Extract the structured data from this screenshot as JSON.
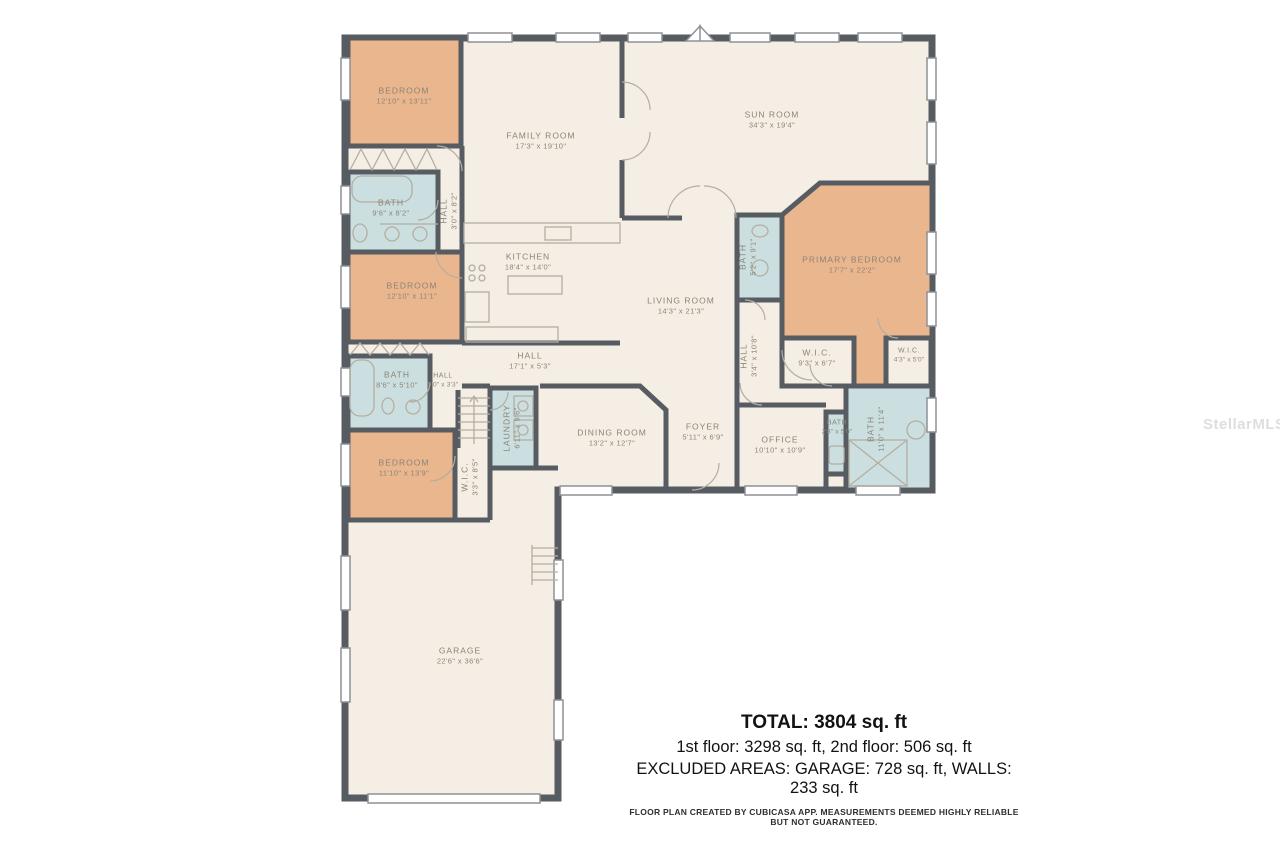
{
  "watermark": "StellarMLS",
  "colors": {
    "wall": "#575c63",
    "floor": "#f5eee4",
    "bedroom_fill": "#eab68e",
    "bath_fill": "#cbdfe0",
    "label_text": "#8b8476",
    "summary_text": "#121212"
  },
  "rooms": [
    {
      "id": "bedroom-1",
      "name": "BEDROOM",
      "dims": "12'10\" x 13'11\""
    },
    {
      "id": "family-room",
      "name": "FAMILY ROOM",
      "dims": "17'3\" x 19'10\""
    },
    {
      "id": "sun-room",
      "name": "SUN ROOM",
      "dims": "34'3\" x 19'4\""
    },
    {
      "id": "bath-1",
      "name": "BATH",
      "dims": "9'6\" x 8'2\""
    },
    {
      "id": "hall-1",
      "name": "HALL",
      "dims": "3'0\" x 8'2\""
    },
    {
      "id": "kitchen",
      "name": "KITCHEN",
      "dims": "18'4\" x 14'0\""
    },
    {
      "id": "bedroom-2",
      "name": "BEDROOM",
      "dims": "12'10\" x 11'1\""
    },
    {
      "id": "primary-bedroom",
      "name": "PRIMARY BEDROOM",
      "dims": "17'7\" x 22'2\""
    },
    {
      "id": "primary-hall-bath",
      "name": "BATH",
      "dims": "5'2\" x 9'1\""
    },
    {
      "id": "living-room",
      "name": "LIVING ROOM",
      "dims": "14'3\" x 21'3\""
    },
    {
      "id": "hall-main",
      "name": "HALL",
      "dims": "17'1\" x 5'3\""
    },
    {
      "id": "hall-primary",
      "name": "HALL",
      "dims": "3'4\" x 10'8\""
    },
    {
      "id": "wic-1",
      "name": "W.I.C.",
      "dims": "9'3\" x 6'7\""
    },
    {
      "id": "wic-2",
      "name": "W.I.C.",
      "dims": "4'3\" x 5'0\""
    },
    {
      "id": "bath-2",
      "name": "BATH",
      "dims": "8'6\" x 5'10\""
    },
    {
      "id": "hall-2",
      "name": "HALL",
      "dims": "5'0\" x 3'3\""
    },
    {
      "id": "laundry",
      "name": "LAUNDRY",
      "dims": "6'11\" x 9'6\""
    },
    {
      "id": "dining-room",
      "name": "DINING ROOM",
      "dims": "13'2\" x 12'7\""
    },
    {
      "id": "foyer",
      "name": "FOYER",
      "dims": "5'11\" x 6'9\""
    },
    {
      "id": "office",
      "name": "OFFICE",
      "dims": "10'10\" x 10'9\""
    },
    {
      "id": "bath-3",
      "name": "BATH",
      "dims": "2'8\" x 5'0\""
    },
    {
      "id": "primary-bath",
      "name": "BATH",
      "dims": "11'0\" x 11'4\""
    },
    {
      "id": "bedroom-3",
      "name": "BEDROOM",
      "dims": "11'10\" x 13'9\""
    },
    {
      "id": "wic-3",
      "name": "W.I.C.",
      "dims": "3'3\" x 8'5\""
    },
    {
      "id": "garage",
      "name": "GARAGE",
      "dims": "22'6\" x 36'6\""
    }
  ],
  "summary": {
    "total": "TOTAL: 3804 sq. ft",
    "floors": "1st floor: 3298 sq. ft, 2nd floor: 506 sq. ft",
    "excluded": "EXCLUDED AREAS: GARAGE: 728 sq. ft, WALLS: 233 sq. ft",
    "disclaimer": "FLOOR PLAN CREATED BY CUBICASA APP. MEASUREMENTS DEEMED HIGHLY RELIABLE BUT NOT GUARANTEED."
  }
}
